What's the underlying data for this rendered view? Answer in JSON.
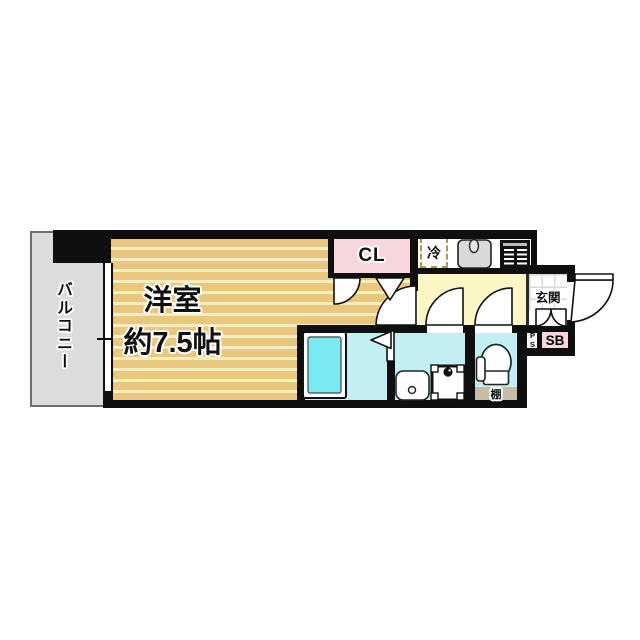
{
  "floorplan": {
    "balcony": {
      "label": "バルコニー"
    },
    "main_room": {
      "label": "洋室",
      "size": "約7.5帖"
    },
    "closet": {
      "label": "CL"
    },
    "kitchen": {
      "refrigerator_label": "冷"
    },
    "entrance": {
      "label": "玄関"
    },
    "shoebox": {
      "label": "SB"
    },
    "pipe_space": {
      "label": "PS"
    },
    "toilet": {
      "shelf_label": "棚"
    },
    "colors": {
      "wall": "#0f0f0f",
      "room_floor": "#e9c87e",
      "room_stripe": "#f6ecc4",
      "closet_pink": "#f7d6de",
      "hall_yellow": "#fbf7c5",
      "wet_area_cyan": "#c2eff3",
      "bathtub_cyan": "#79e9f2",
      "balcony_gray": "#dcdcdc",
      "shelf_tan": "#c9bca6"
    }
  }
}
